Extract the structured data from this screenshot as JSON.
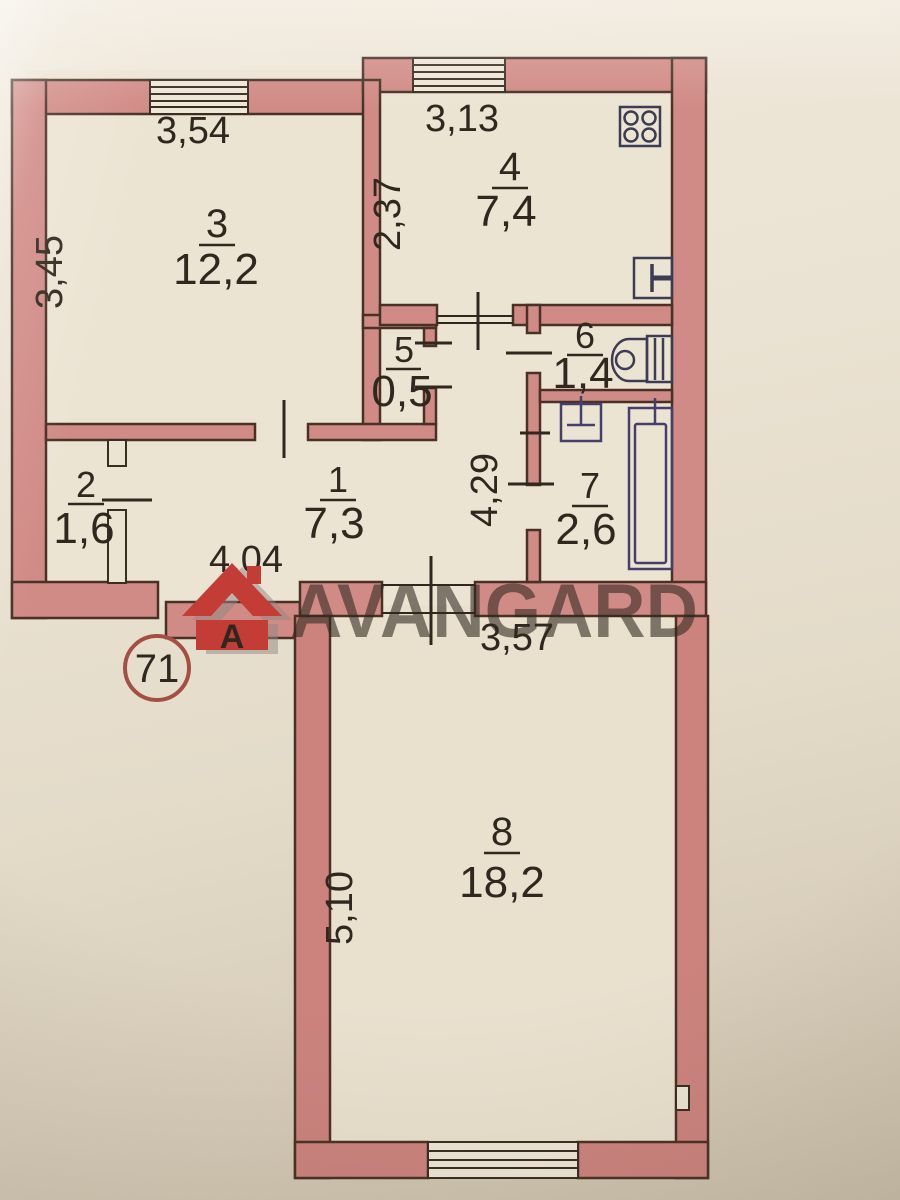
{
  "plan": {
    "watermark": "AVANGARD",
    "logo_letter": "A",
    "unit_number": "71",
    "rooms": [
      {
        "number": "1",
        "area": "7,3"
      },
      {
        "number": "2",
        "area": "1,6"
      },
      {
        "number": "3",
        "area": "12,2"
      },
      {
        "number": "4",
        "area": "7,4"
      },
      {
        "number": "5",
        "area": "0,5"
      },
      {
        "number": "6",
        "area": "1,4"
      },
      {
        "number": "7",
        "area": "2,6"
      },
      {
        "number": "8",
        "area": "18,2"
      }
    ],
    "dimensions": [
      {
        "name": "room-3-width",
        "value": "3,54"
      },
      {
        "name": "room-4-width",
        "value": "3,13"
      },
      {
        "name": "room-3-depth",
        "value": "3,45"
      },
      {
        "name": "room-4-depth",
        "value": "2,37"
      },
      {
        "name": "hall-depth",
        "value": "4,29"
      },
      {
        "name": "hall-width",
        "value": "4,04"
      },
      {
        "name": "room-8-width",
        "value": "3,57"
      },
      {
        "name": "room-8-depth",
        "value": "5,10"
      }
    ],
    "icons": [
      "stove-icon",
      "kitchen-sink-icon",
      "toilet-icon",
      "washbasin-icon",
      "bathtub-icon",
      "avangard-logo-icon"
    ],
    "colors": {
      "wall": "#d18b86",
      "wall_outline": "#4a3126",
      "paper": "#e8dfcf",
      "ink": "#30281f",
      "fixture_blue": "#44406b",
      "logo_red": "#c33c36",
      "watermark_gray": "#57504f",
      "badge_red": "#8f4438"
    }
  }
}
